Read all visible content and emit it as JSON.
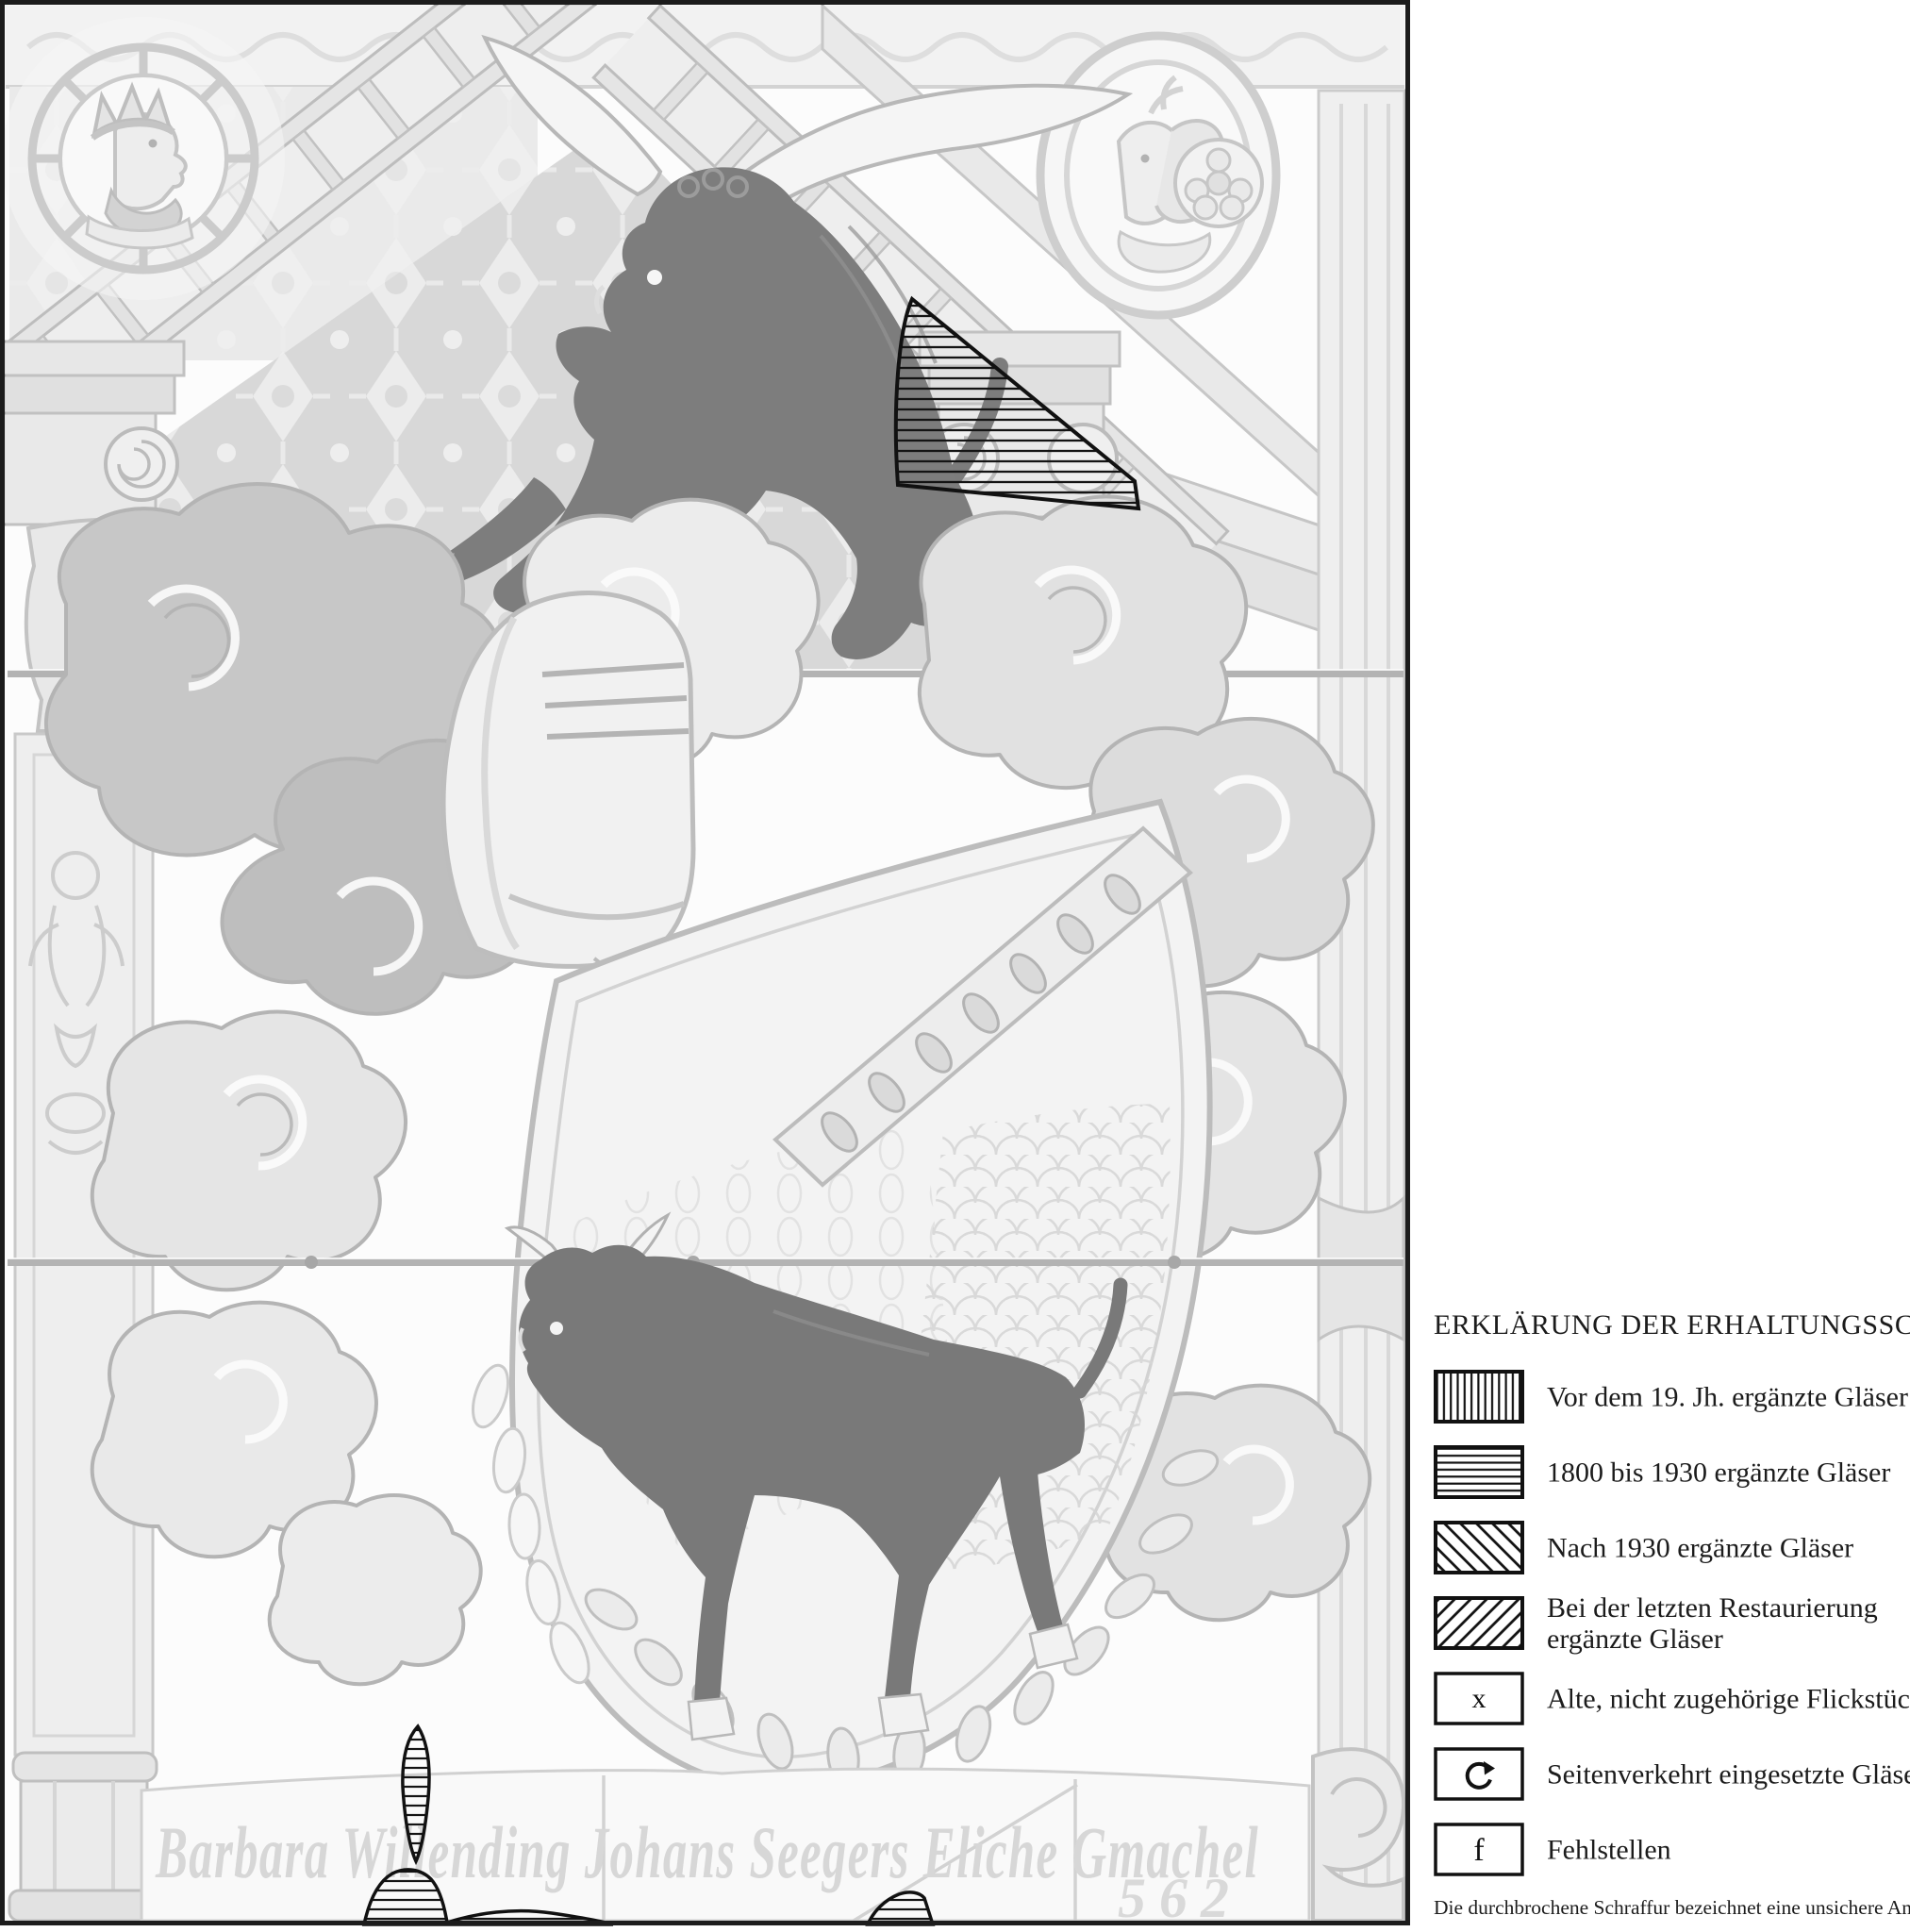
{
  "legend": {
    "title": "ERKLÄRUNG DER ERHALTUNGSSCHEMATA",
    "items": [
      {
        "id": "pre-19th-century",
        "pattern": "vertical-hatch",
        "label": "Vor dem 19. Jh. ergänzte Gläser"
      },
      {
        "id": "1800-1930",
        "pattern": "horizontal-hatch",
        "label": "1800 bis 1930 ergänzte Gläser"
      },
      {
        "id": "after-1930",
        "pattern": "diagonal-hatch-backward",
        "label": "Nach 1930 ergänzte Gläser"
      },
      {
        "id": "last-restoration",
        "pattern": "diagonal-hatch-forward",
        "label": "Bei der letzten Restaurierung ergänzte Gläser",
        "label_line1": "Bei der letzten Restaurierung",
        "label_line2": "ergänzte Gläser"
      },
      {
        "id": "old-foreign-patches",
        "pattern": "letter-symbol",
        "symbol": "x",
        "label": "Alte, nicht zugehörige Flickstücke"
      },
      {
        "id": "reversed-glasses",
        "pattern": "rotate-arrow-icon",
        "icon": "rotate-clockwise-arrow",
        "label": "Seitenverkehrt eingesetzte Gläser"
      },
      {
        "id": "losses",
        "pattern": "letter-symbol",
        "symbol": "f",
        "label": "Fehlstellen"
      }
    ],
    "footnote": "Die durchbrochene Schraffur bezeichnet eine unsichere Angabe"
  },
  "panel": {
    "type": "stained-glass-conservation-photograph",
    "inscription": "Barbara Willending Johans Seegers Eliche Gmachel",
    "year": "562",
    "overlay_regions": [
      {
        "id": "region-upper-right-triangle",
        "pattern": "horizontal-hatch",
        "classification": "1800 bis 1930 ergänzte Gläser"
      },
      {
        "id": "region-lower-blade",
        "pattern": "horizontal-hatch",
        "classification": "1800 bis 1930 ergänzte Gläser"
      },
      {
        "id": "region-lower-mound",
        "pattern": "horizontal-hatch",
        "classification": "1800 bis 1930 ergänzte Gläser"
      },
      {
        "id": "region-lower-small-wedge",
        "pattern": "horizontal-hatch",
        "classification": "1800 bis 1930 ergänzte Gläser"
      }
    ]
  }
}
